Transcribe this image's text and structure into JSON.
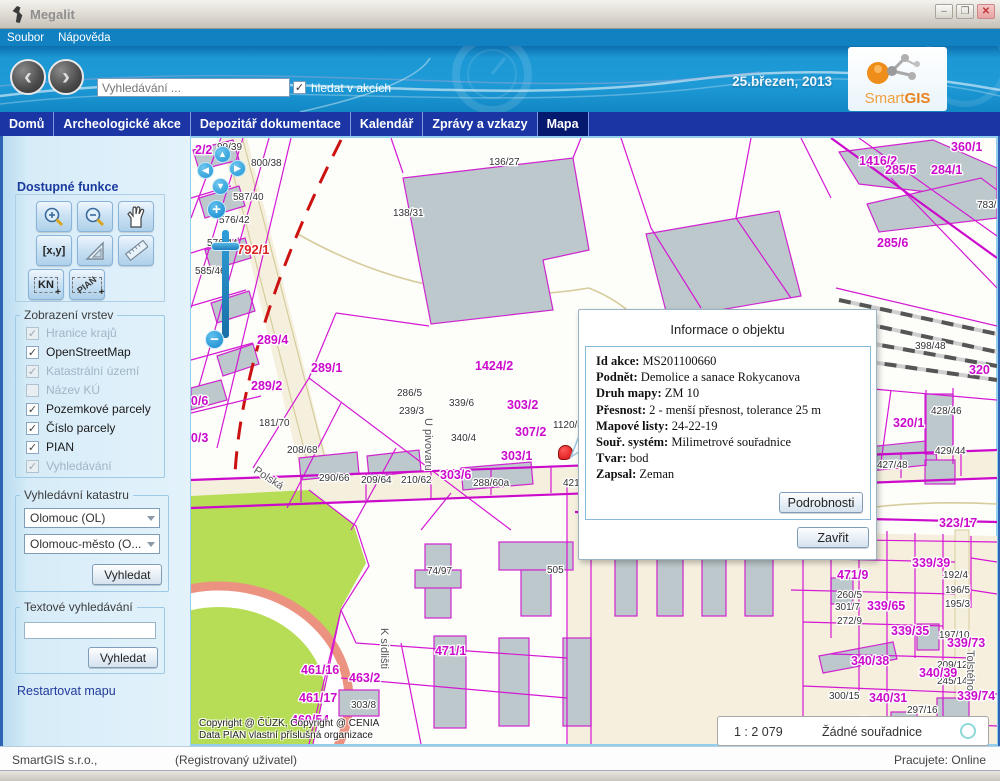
{
  "window": {
    "title": "Megalit",
    "minimize": "–",
    "maximize": "❐",
    "close": "✕"
  },
  "menu": {
    "items": [
      "Soubor",
      "Nápověda"
    ]
  },
  "header": {
    "search_placeholder": "Vyhledávání ...",
    "search_checkbox_label": "hledat v akcích",
    "date": "25.březen, 2013",
    "logo_smart": "Smart",
    "logo_gis": "GIS"
  },
  "nav": {
    "items": [
      {
        "label": "Domů",
        "active": false
      },
      {
        "label": "Archeologické akce",
        "active": false
      },
      {
        "label": "Depozitář dokumentace",
        "active": false
      },
      {
        "label": "Kalendář",
        "active": false
      },
      {
        "label": "Zprávy a vzkazy",
        "active": false
      },
      {
        "label": "Mapa",
        "active": true
      }
    ]
  },
  "sidebar": {
    "functions_title": "Dostupné funkce",
    "tool_xy": "[x,y]",
    "tool_kn": "KN",
    "tool_pian": "PIAN",
    "layers_title": "Zobrazení vrstev",
    "layers": [
      {
        "label": "Hranice krajů",
        "checked": true,
        "disabled": true
      },
      {
        "label": "OpenStreetMap",
        "checked": true,
        "disabled": false
      },
      {
        "label": "Katastrální území",
        "checked": true,
        "disabled": true
      },
      {
        "label": "Název KÚ",
        "checked": false,
        "disabled": true
      },
      {
        "label": "Pozemkové parcely",
        "checked": true,
        "disabled": false
      },
      {
        "label": "Číslo parcely",
        "checked": true,
        "disabled": false
      },
      {
        "label": "PIAN",
        "checked": true,
        "disabled": false
      },
      {
        "label": "Vyhledávání",
        "checked": true,
        "disabled": true
      }
    ],
    "cadastre_title": "Vyhledávní katastru",
    "cadastre_select1": "Olomouc (OL)",
    "cadastre_select2": "Olomouc-město (O...",
    "cadastre_button": "Vyhledat",
    "text_search_title": "Textové vyhledávání",
    "text_search_button": "Vyhledat",
    "restart_link": "Restartovat mapu"
  },
  "popup": {
    "title": "Informace o objektu",
    "fields": [
      {
        "label": "Id akce:",
        "value": "MS201100660"
      },
      {
        "label": "Podnět:",
        "value": "Demolice a sanace Rokycanova"
      },
      {
        "label": "Druh mapy:",
        "value": "ZM 10"
      },
      {
        "label": "Přesnost:",
        "value": "2 - menší přesnost, tolerance 25 m"
      },
      {
        "label": "Mapové listy:",
        "value": "24-22-19"
      },
      {
        "label": "Souř. systém:",
        "value": "Milimetrové souřadnice"
      },
      {
        "label": "Tvar:",
        "value": "bod"
      },
      {
        "label": "Zapsal:",
        "value": "Zeman"
      }
    ],
    "details_button": "Podrobnosti",
    "close_button": "Zavřit"
  },
  "map": {
    "scale": "1 : 2 079",
    "coords": "Žádné souřadnice",
    "copyright_line1": "Copyright @ ČÚZK, Copyright @ CENIA",
    "copyright_line2": "Data PIAN vlastní příslušná organizace",
    "labels": [
      {
        "t": "99/39",
        "x": 26,
        "y": 12,
        "c": "s"
      },
      {
        "t": "800/38",
        "x": 60,
        "y": 28,
        "c": "s"
      },
      {
        "t": "587/40",
        "x": 42,
        "y": 62,
        "c": "s"
      },
      {
        "t": "576/42",
        "x": 28,
        "y": 85,
        "c": "s"
      },
      {
        "t": "576/44",
        "x": 16,
        "y": 108,
        "c": "s"
      },
      {
        "t": "585/46",
        "x": 4,
        "y": 136,
        "c": "s"
      },
      {
        "t": "136/27",
        "x": 298,
        "y": 27,
        "c": "s"
      },
      {
        "t": "138/31",
        "x": 202,
        "y": 78,
        "c": "s"
      },
      {
        "t": "181/70",
        "x": 68,
        "y": 288,
        "c": "s"
      },
      {
        "t": "208/68",
        "x": 96,
        "y": 315,
        "c": "s"
      },
      {
        "t": "290/66",
        "x": 128,
        "y": 343,
        "c": "s"
      },
      {
        "t": "209/64",
        "x": 170,
        "y": 345,
        "c": "s"
      },
      {
        "t": "210/62",
        "x": 210,
        "y": 345,
        "c": "s"
      },
      {
        "t": "288/60a",
        "x": 282,
        "y": 348,
        "c": "s"
      },
      {
        "t": "421/58",
        "x": 372,
        "y": 348,
        "c": "s"
      },
      {
        "t": "419/54",
        "x": 452,
        "y": 343,
        "c": "s"
      },
      {
        "t": "418/52",
        "x": 530,
        "y": 337,
        "c": "s"
      },
      {
        "t": "416/50",
        "x": 576,
        "y": 335,
        "c": "s"
      },
      {
        "t": "427/48",
        "x": 686,
        "y": 330,
        "c": "s"
      },
      {
        "t": "428/46",
        "x": 740,
        "y": 276,
        "c": "s"
      },
      {
        "t": "429/44",
        "x": 744,
        "y": 316,
        "c": "s"
      },
      {
        "t": "398/48",
        "x": 724,
        "y": 211,
        "c": "s"
      },
      {
        "t": "783/5",
        "x": 786,
        "y": 70,
        "c": "s"
      },
      {
        "t": "286/5",
        "x": 206,
        "y": 258,
        "c": "s"
      },
      {
        "t": "239/3",
        "x": 208,
        "y": 276,
        "c": "s"
      },
      {
        "t": "339/6",
        "x": 258,
        "y": 268,
        "c": "s"
      },
      {
        "t": "340/4",
        "x": 260,
        "y": 303,
        "c": "s"
      },
      {
        "t": "1120/8",
        "x": 362,
        "y": 290,
        "c": "s"
      },
      {
        "t": "74/97",
        "x": 236,
        "y": 436,
        "c": "s"
      },
      {
        "t": "505",
        "x": 356,
        "y": 435,
        "c": "s"
      },
      {
        "t": "303/8",
        "x": 160,
        "y": 570,
        "c": "s"
      },
      {
        "t": "192/4",
        "x": 752,
        "y": 440,
        "c": "s"
      },
      {
        "t": "196/5",
        "x": 754,
        "y": 455,
        "c": "s"
      },
      {
        "t": "195/3",
        "x": 754,
        "y": 469,
        "c": "s"
      },
      {
        "t": "197/10",
        "x": 748,
        "y": 500,
        "c": "s"
      },
      {
        "t": "209/12",
        "x": 746,
        "y": 530,
        "c": "s"
      },
      {
        "t": "245/14",
        "x": 746,
        "y": 546,
        "c": "s"
      },
      {
        "t": "260/5",
        "x": 646,
        "y": 460,
        "c": "s"
      },
      {
        "t": "301/7",
        "x": 644,
        "y": 472,
        "c": "s"
      },
      {
        "t": "272/9",
        "x": 646,
        "y": 486,
        "c": "s"
      },
      {
        "t": "300/15",
        "x": 638,
        "y": 561,
        "c": "s"
      },
      {
        "t": "297/16",
        "x": 716,
        "y": 575,
        "c": "s"
      },
      {
        "t": "184/12",
        "x": 654,
        "y": 586,
        "c": "s"
      },
      {
        "t": "2/2",
        "x": 4,
        "y": 16,
        "c": "b"
      },
      {
        "t": "792/1",
        "x": 46,
        "y": 116,
        "c": "r"
      },
      {
        "t": "289/4",
        "x": 66,
        "y": 206,
        "c": "b"
      },
      {
        "t": "289/1",
        "x": 120,
        "y": 234,
        "c": "b"
      },
      {
        "t": "289/2",
        "x": 60,
        "y": 252,
        "c": "b"
      },
      {
        "t": "800/6",
        "x": -14,
        "y": 267,
        "c": "b"
      },
      {
        "t": "800/3",
        "x": -14,
        "y": 304,
        "c": "b"
      },
      {
        "t": "1424/2",
        "x": 284,
        "y": 232,
        "c": "b"
      },
      {
        "t": "303/2",
        "x": 316,
        "y": 271,
        "c": "b"
      },
      {
        "t": "307/2",
        "x": 324,
        "y": 298,
        "c": "b"
      },
      {
        "t": "303/1",
        "x": 310,
        "y": 322,
        "c": "b"
      },
      {
        "t": "303/6",
        "x": 249,
        "y": 341,
        "c": "b"
      },
      {
        "t": "306/2",
        "x": 524,
        "y": 315,
        "c": "b"
      },
      {
        "t": "306/1",
        "x": 572,
        "y": 315,
        "c": "b"
      },
      {
        "t": "323/13",
        "x": 399,
        "y": 397,
        "c": "b"
      },
      {
        "t": "323/12",
        "x": 626,
        "y": 389,
        "c": "b"
      },
      {
        "t": "323/17",
        "x": 748,
        "y": 389,
        "c": "b"
      },
      {
        "t": "471/8",
        "x": 642,
        "y": 412,
        "c": "b"
      },
      {
        "t": "471/9",
        "x": 646,
        "y": 441,
        "c": "b"
      },
      {
        "t": "339/39",
        "x": 721,
        "y": 429,
        "c": "b"
      },
      {
        "t": "339/65",
        "x": 676,
        "y": 472,
        "c": "b"
      },
      {
        "t": "339/35",
        "x": 700,
        "y": 497,
        "c": "b"
      },
      {
        "t": "339/73",
        "x": 756,
        "y": 509,
        "c": "b"
      },
      {
        "t": "340/38",
        "x": 660,
        "y": 527,
        "c": "b"
      },
      {
        "t": "340/39",
        "x": 728,
        "y": 539,
        "c": "b"
      },
      {
        "t": "340/31",
        "x": 678,
        "y": 564,
        "c": "b"
      },
      {
        "t": "339/74",
        "x": 766,
        "y": 562,
        "c": "b"
      },
      {
        "t": "471/1",
        "x": 244,
        "y": 517,
        "c": "b"
      },
      {
        "t": "461/16",
        "x": 110,
        "y": 536,
        "c": "b"
      },
      {
        "t": "463/2",
        "x": 158,
        "y": 544,
        "c": "b"
      },
      {
        "t": "461/17",
        "x": 108,
        "y": 564,
        "c": "b"
      },
      {
        "t": "460/54",
        "x": 100,
        "y": 586,
        "c": "b"
      },
      {
        "t": "320/1",
        "x": 702,
        "y": 289,
        "c": "b"
      },
      {
        "t": "320",
        "x": 778,
        "y": 236,
        "c": "b"
      },
      {
        "t": "360/1",
        "x": 760,
        "y": 13,
        "c": "b"
      },
      {
        "t": "1416/2",
        "x": 668,
        "y": 27,
        "c": "b"
      },
      {
        "t": "284/1",
        "x": 740,
        "y": 36,
        "c": "b"
      },
      {
        "t": "285/5",
        "x": 694,
        "y": 36,
        "c": "b"
      },
      {
        "t": "285/6",
        "x": 686,
        "y": 109,
        "c": "b"
      },
      {
        "t": "U pivovaru",
        "x": 234,
        "y": 280,
        "c": "st",
        "r": 90
      },
      {
        "t": "Polská",
        "x": 62,
        "y": 334,
        "c": "st",
        "r": 33
      },
      {
        "t": "K sídlišti",
        "x": 190,
        "y": 490,
        "c": "st",
        "r": 90
      },
      {
        "t": "Tolstého",
        "x": 776,
        "y": 512,
        "c": "st",
        "r": 90
      }
    ]
  },
  "statusbar": {
    "company": "SmartGIS s.r.o.,",
    "user": "(Registrovaný uživatel)",
    "status_label": "Pracujete:",
    "status_value": "Online"
  }
}
